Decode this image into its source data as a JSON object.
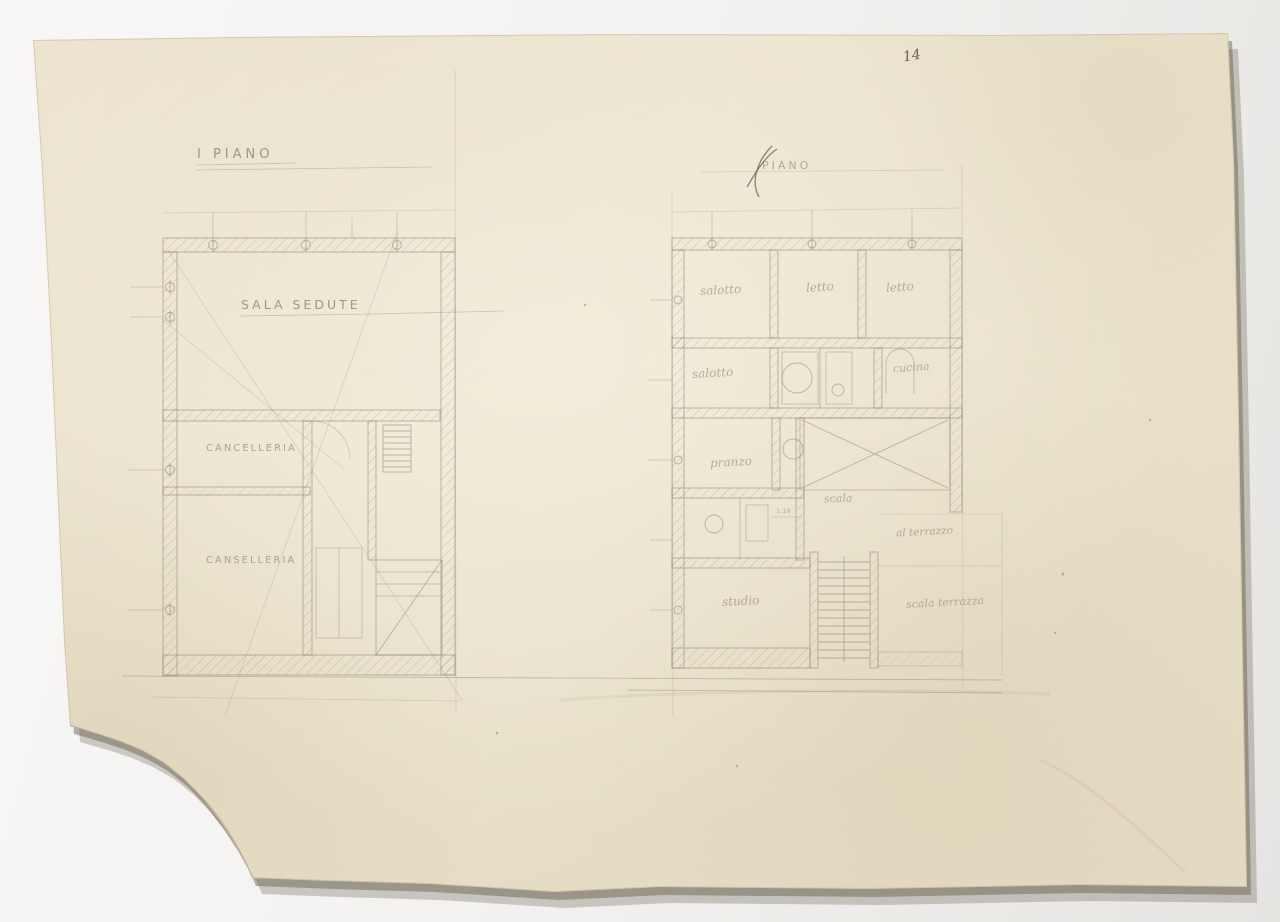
{
  "scene": {
    "description": "Photograph of an aged pencil architectural drawing sheet with two floor plans, torn bottom-left corner",
    "background_color": "#f3f2f0",
    "paper_color": "#e9e1ca",
    "pencil_color": "#8e8472"
  },
  "annotations": {
    "corner_mark": "14"
  },
  "plans": {
    "left": {
      "title": "I PIANO",
      "labels": {
        "sala_sedute": "SALA SEDUTE",
        "cancelleria_upper": "CANCELLERIA",
        "cancelleria_lower": "CANSELLERIA"
      }
    },
    "right": {
      "title": "PIANO",
      "labels": {
        "salotto_top": "salotto",
        "letto_mid": "letto",
        "letto_right": "letto",
        "salotto_mid": "salotto",
        "cucina": "cucina",
        "pranzo": "pranzo",
        "scala": "scala",
        "al_terrazzo": "al terrazzo",
        "studio": "studio",
        "scala_terrazza": "scala terrazza",
        "dim_small": "1.19"
      }
    }
  }
}
